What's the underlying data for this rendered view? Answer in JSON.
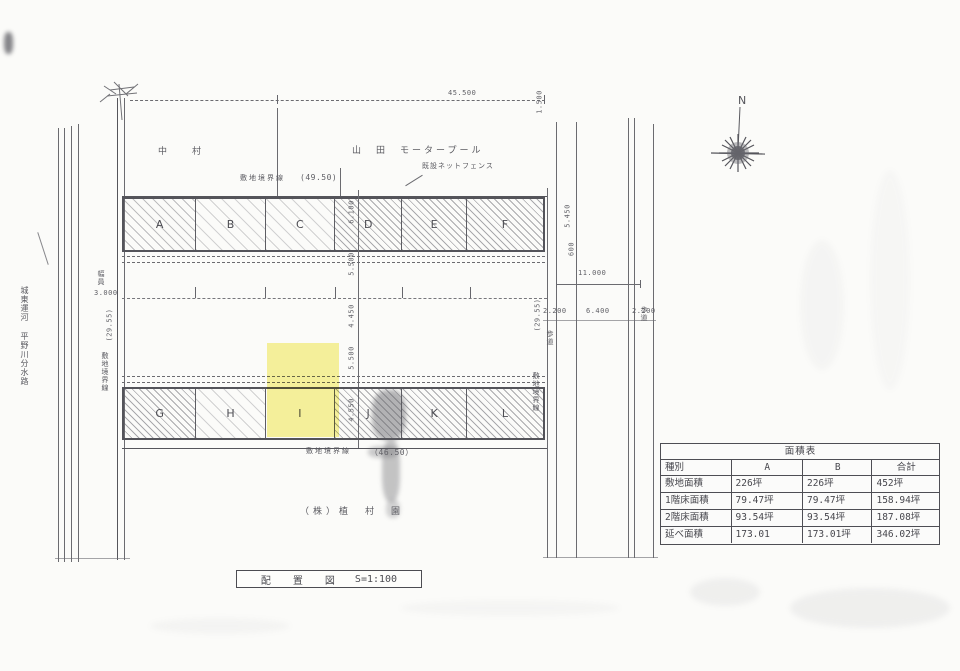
{
  "title_block": {
    "name": "配　置　図",
    "scale": "S=1:100"
  },
  "compass": {
    "north": "N"
  },
  "neighbors": {
    "left": "中　村",
    "right": "山　田　モータープール",
    "fence": "既設ネットフェンス",
    "owner": "（株）植　村　園"
  },
  "waterway": {
    "canal": "城東運河",
    "river": "平野川分水路"
  },
  "boundaries": {
    "top_label": "敷地境界線",
    "top_dim": "(49.50)",
    "bottom_label": "敷地境界線",
    "bottom_dim": "（46.50）",
    "left_label": "敷地境界線",
    "right_label": "敷地境界線"
  },
  "roads": {
    "sidewalk_left": "歩道",
    "sidewalk_right": "歩道",
    "width_label": "幅員",
    "width_value": "3.000"
  },
  "dims": {
    "top_width": "45.500",
    "top_right": "1.500",
    "right_total": "11.000",
    "right_parts": [
      "2.200",
      "6.400",
      "2.200"
    ],
    "right_upper": [
      "5.450",
      "600"
    ],
    "left_length": "(29.55)",
    "right_length": "(29.55)",
    "center_column": [
      "6.100",
      "5.500",
      "4.450",
      "5.500",
      "4.550"
    ]
  },
  "plots": {
    "top": [
      "A",
      "B",
      "C",
      "D",
      "E",
      "F"
    ],
    "bottom": [
      "G",
      "H",
      "I",
      "J",
      "K",
      "L"
    ],
    "highlighted": "I"
  },
  "area_table": {
    "title": "面積表",
    "columns": [
      "種別",
      "A",
      "B",
      "合計"
    ],
    "rows": [
      {
        "label": "敷地面積",
        "a": "226坪",
        "b": "226坪",
        "total": "452坪"
      },
      {
        "label": "1階床面積",
        "a": "79.47坪",
        "b": "79.47坪",
        "total": "158.94坪"
      },
      {
        "label": "2階床面積",
        "a": "93.54坪",
        "b": "93.54坪",
        "total": "187.08坪"
      },
      {
        "label": "延べ面積",
        "a": "173.01",
        "b": "173.01坪",
        "total": "346.02坪"
      }
    ]
  }
}
